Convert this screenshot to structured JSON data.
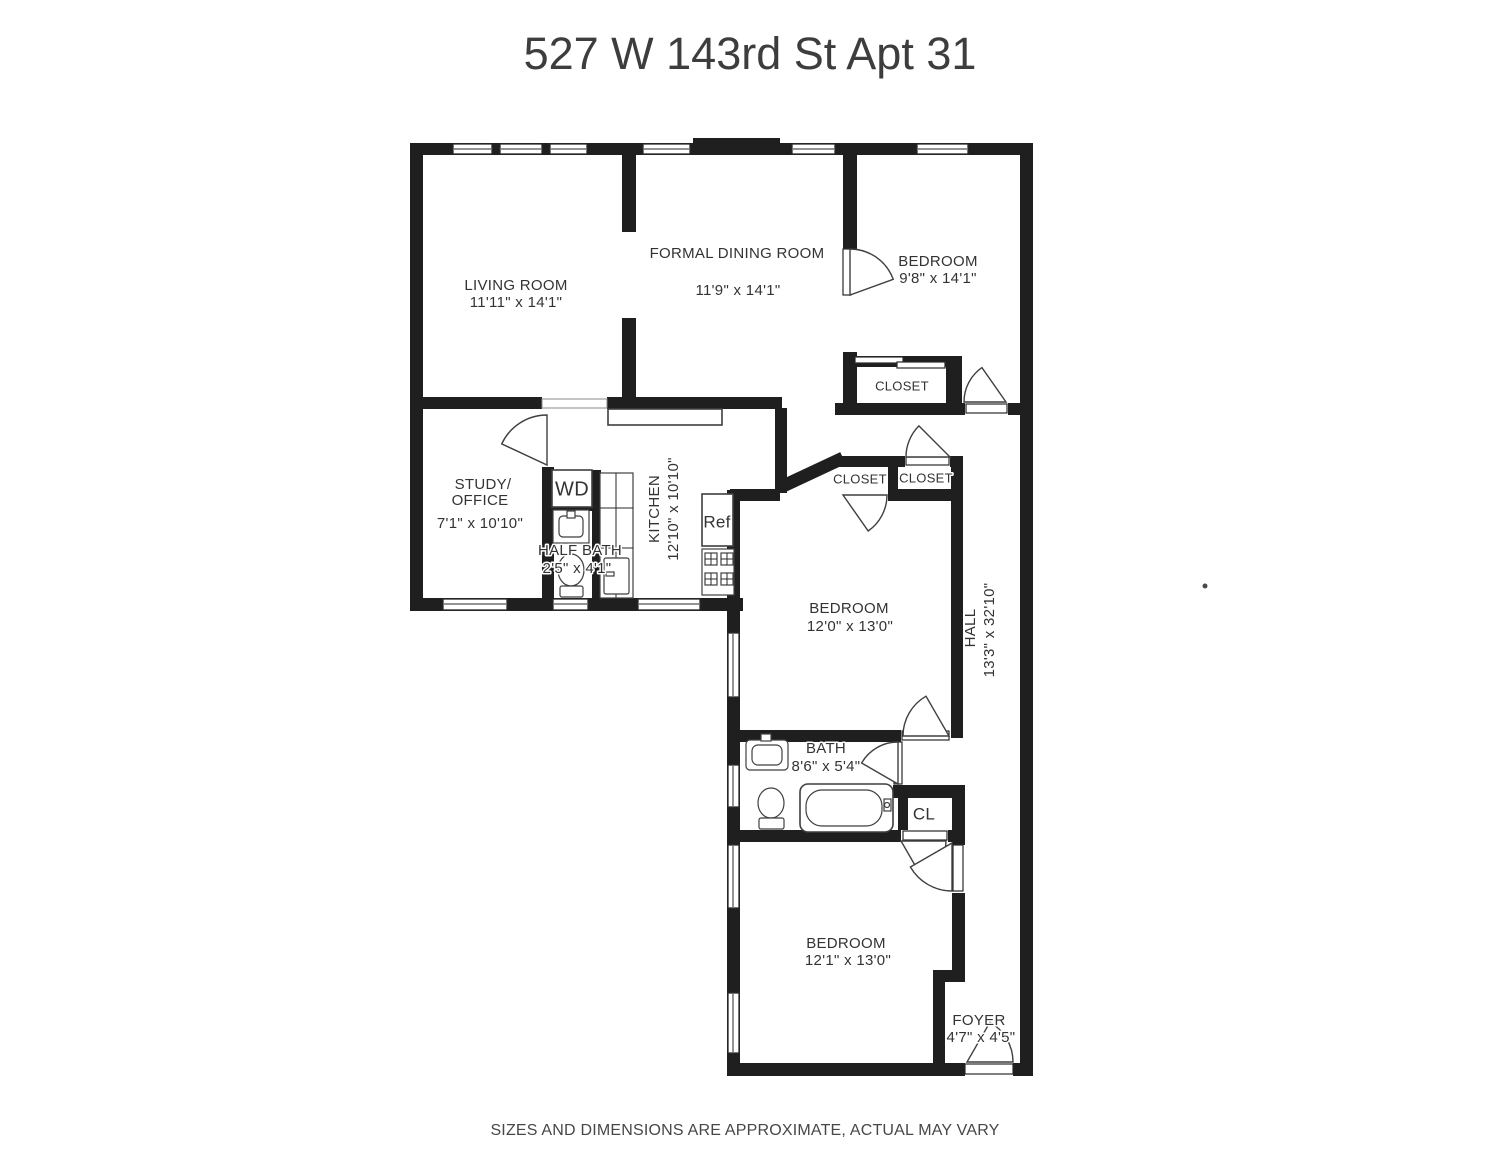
{
  "title": "527 W 143rd St Apt 31",
  "footer": "SIZES AND DIMENSIONS ARE APPROXIMATE, ACTUAL MAY VARY",
  "colors": {
    "wall": "#1f1f1f",
    "line": "#3f3f3f",
    "text": "#333333",
    "bg": "#ffffff"
  },
  "rooms": {
    "living_room": {
      "name": "LIVING ROOM",
      "dims": "11'11\" x 14'1\""
    },
    "dining_room": {
      "name": "FORMAL DINING ROOM",
      "dims": "11'9\" x 14'1\""
    },
    "bedroom_top": {
      "name": "BEDROOM",
      "dims": "9'8\" x 14'1\""
    },
    "closet_top": {
      "name": "CLOSET"
    },
    "study": {
      "name_line1": "STUDY/",
      "name_line2": "OFFICE",
      "dims": "7'1\" x 10'10\""
    },
    "washer_dryer": {
      "name": "WD"
    },
    "half_bath": {
      "name": "HALF BATH",
      "dims": "2'5\" x 4'1\""
    },
    "kitchen": {
      "name": "KITCHEN",
      "dims": "12'10\" x 10'10\""
    },
    "refrigerator": {
      "name": "Ref"
    },
    "closet_mid_left": {
      "name": "CLOSET"
    },
    "closet_mid_right": {
      "name": "CLOSET"
    },
    "bedroom_mid": {
      "name": "BEDROOM",
      "dims": "12'0\" x 13'0\""
    },
    "hall": {
      "name": "HALL",
      "dims": "13'3\" x 32'10\""
    },
    "bath": {
      "name": "BATH",
      "dims": "8'6\" x 5'4\""
    },
    "closet_small": {
      "name": "CL"
    },
    "bedroom_bottom": {
      "name": "BEDROOM",
      "dims": "12'1\" x 13'0\""
    },
    "foyer": {
      "name": "FOYER",
      "dims": "4'7\" x 4'5\""
    }
  }
}
